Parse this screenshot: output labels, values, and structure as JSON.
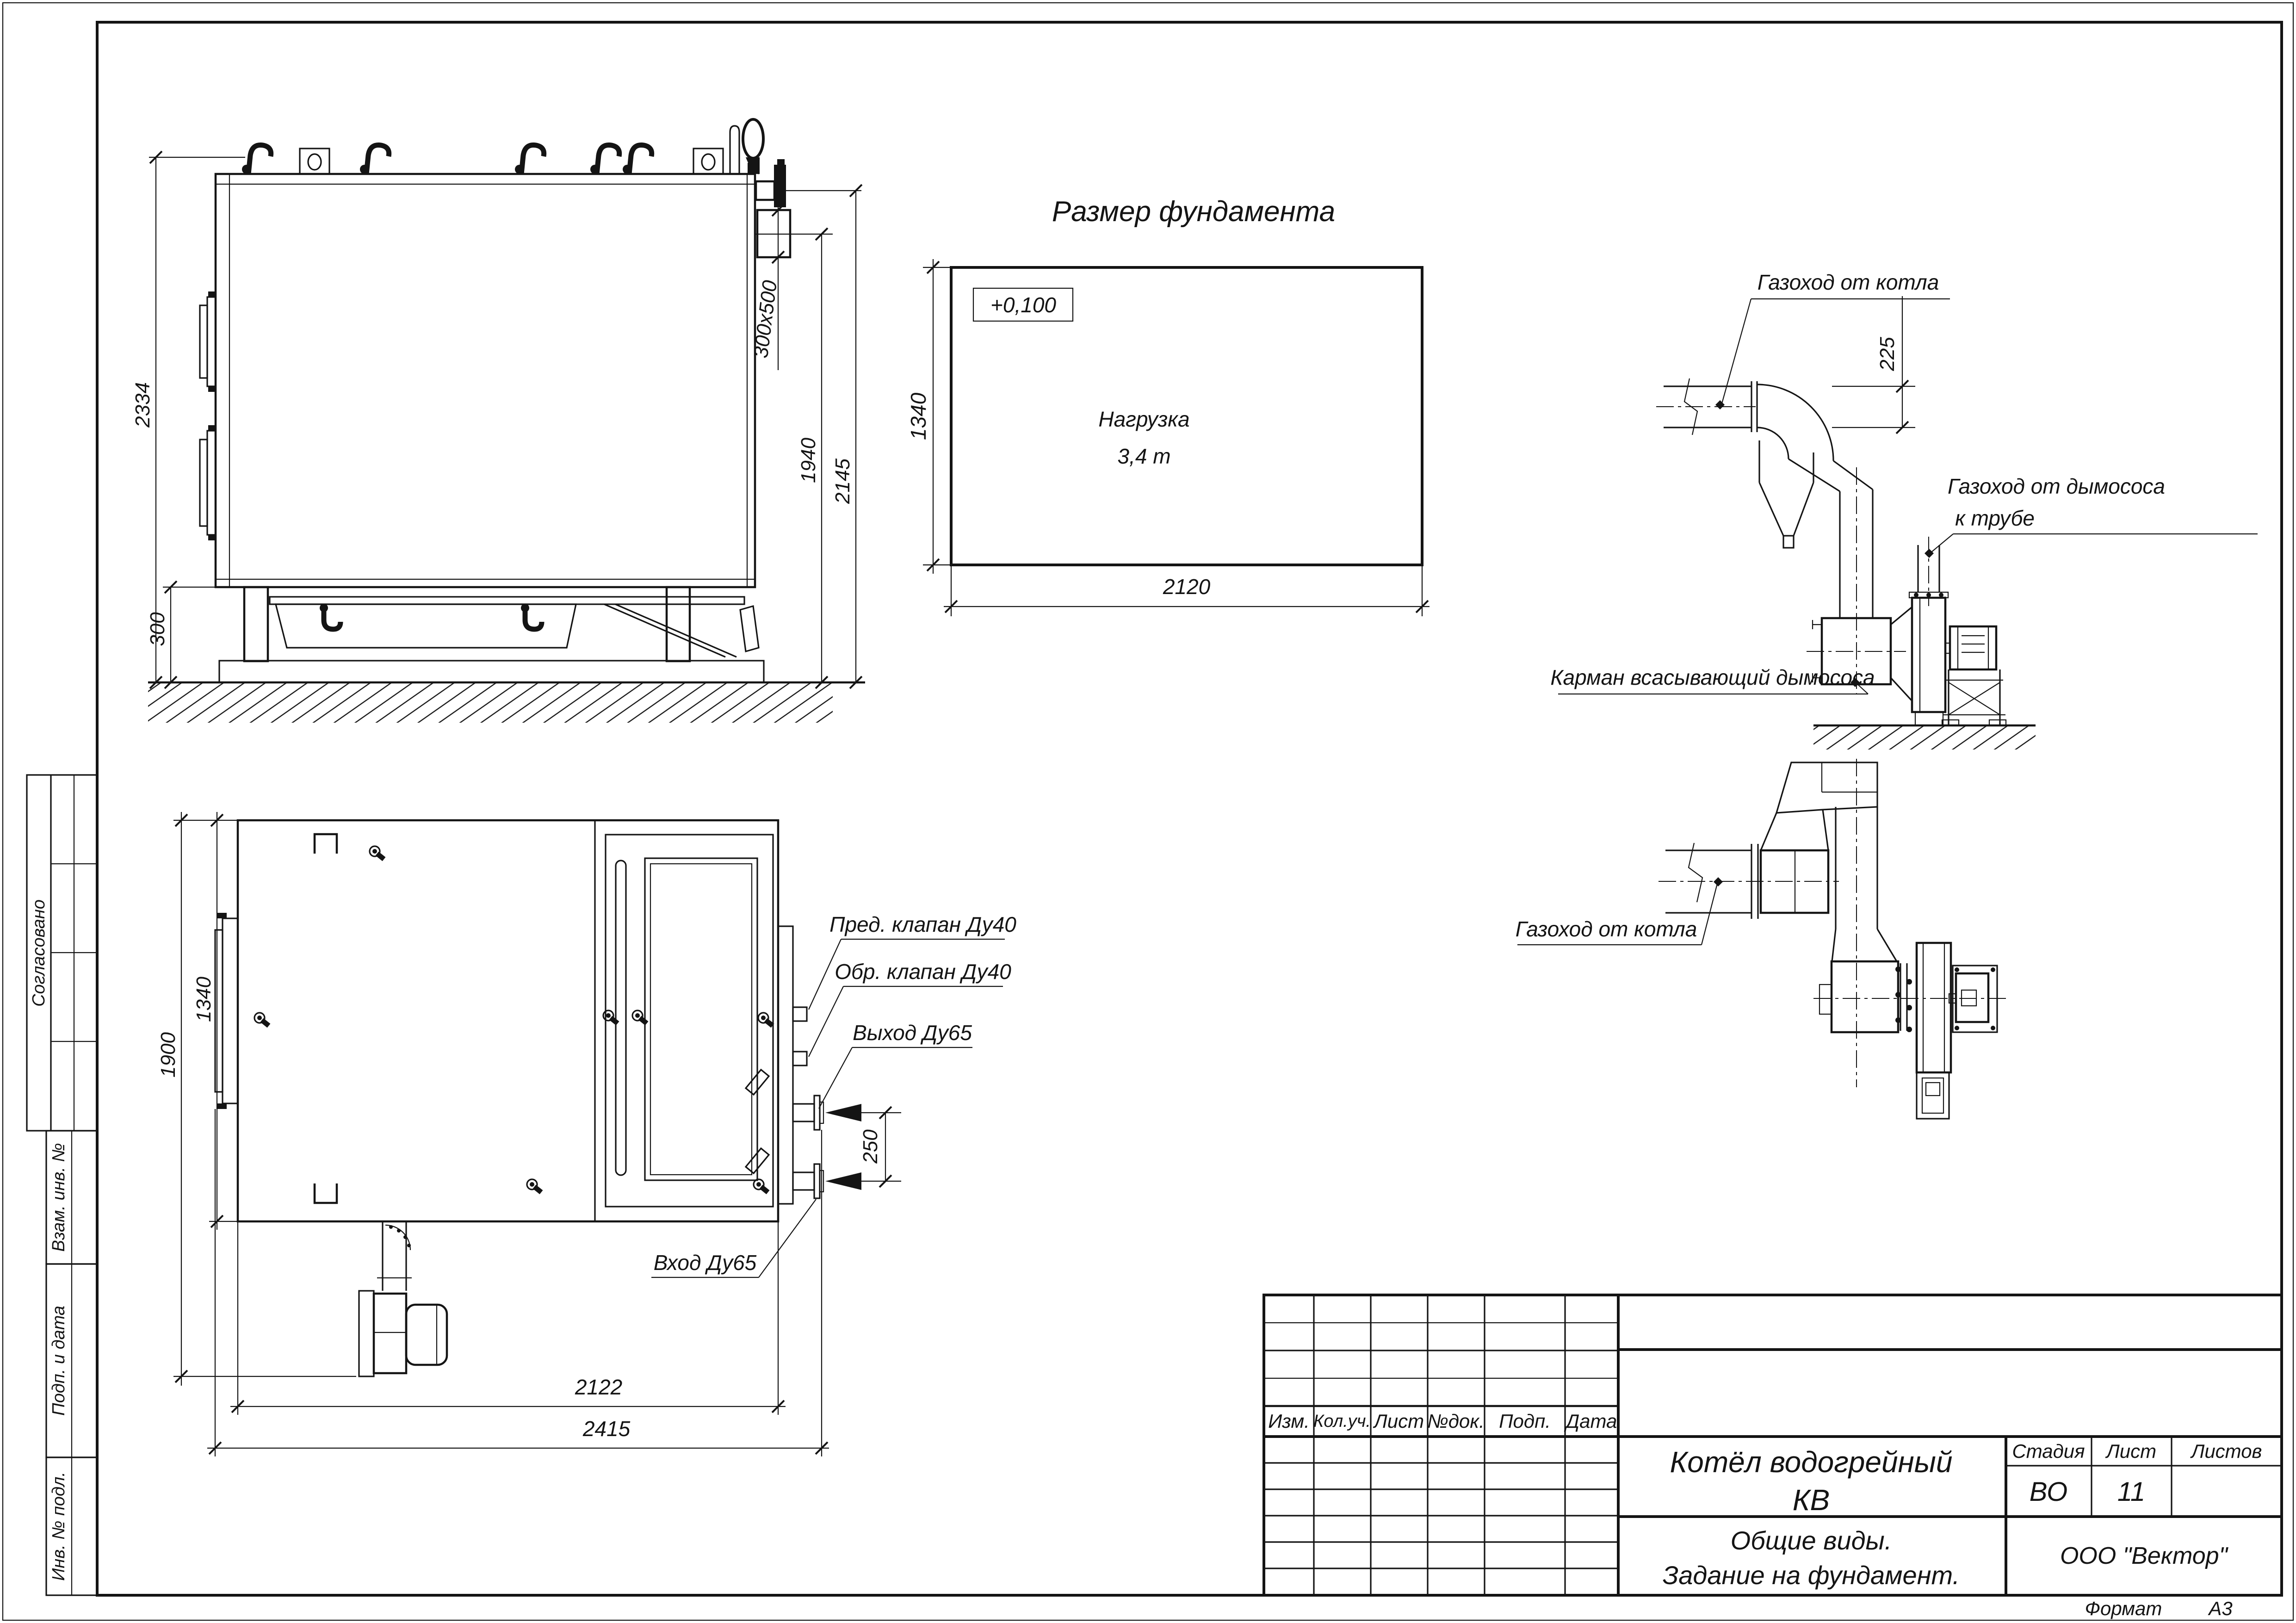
{
  "stamp": {
    "col_izm": "Изм.",
    "col_kol": "Кол.уч.",
    "col_list": "Лист",
    "col_doc": "№док.",
    "col_podp": "Подп.",
    "col_data": "Дата",
    "product_line1": "Котёл водогрейный",
    "product_line2": "КВ",
    "stage_label": "Стадия",
    "sheet_label": "Лист",
    "sheets_label": "Листов",
    "stage_value": "ВО",
    "sheet_value": "11",
    "doc_line1": "Общие виды.",
    "doc_line2": "Задание на фундамент.",
    "company": "ООО \"Вектор\"",
    "format_label": "Формат",
    "format_value": "А3"
  },
  "side_strip": {
    "approved": "Согласовано",
    "vzam": "Взам. инв. №",
    "podp": "Подп. и дата",
    "inv": "Инв. № подл."
  },
  "foundation": {
    "title": "Размер фундамента",
    "mark": "+0,100",
    "load1": "Нагрузка",
    "load2": "3,4 т",
    "width": "2120",
    "depth": "1340"
  },
  "side_view": {
    "h_total": "2334",
    "h_base": "300",
    "h_flue_axis": "1940",
    "h_top": "2145",
    "flue_size": "300х500"
  },
  "plan_view": {
    "w_door": "1900",
    "w_body": "1340",
    "l_body": "2122",
    "l_total": "2415",
    "nozzle_spacing": "250",
    "safety_valve": "Пред. клапан Ду40",
    "check_valve": "Обр. клапан Ду40",
    "outlet": "Выход Ду65",
    "inlet": "Вход Ду65"
  },
  "flue_elevation": {
    "from_boiler": "Газоход от котла",
    "to_stack1": "Газоход от дымососа",
    "to_stack2": "к трубе",
    "pocket": "Карман всасывающий дымососа",
    "duct_height": "225"
  },
  "flue_plan": {
    "from_boiler": "Газоход от котла"
  }
}
